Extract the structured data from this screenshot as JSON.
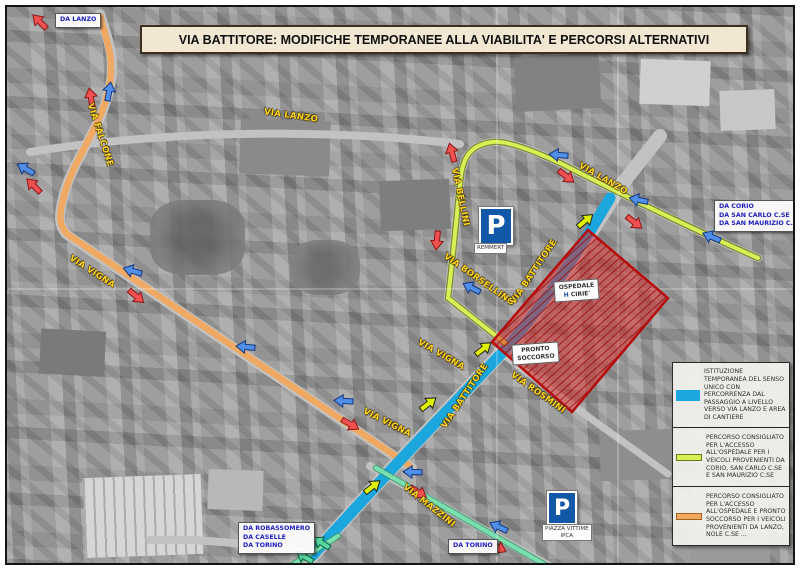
{
  "title": "VIA BATTITORE: MODIFICHE TEMPORANEE ALLA VIABILITA' E PERCORSI ALTERNATIVI",
  "street_labels": {
    "falcone": "VIA FALCONE",
    "vigna_west": "VIA VIGNA",
    "lanzo_top": "VIA LANZO",
    "bellini": "VIA BELLINI",
    "borsellino": "VIA BORSELLINO",
    "battitore_north": "VIA BATTITORE",
    "battitore_south": "VIA BATTITORE",
    "vigna_mid": "VIA VIGNA",
    "vigna_south": "VIA VIGNA",
    "rosmini": "VIA ROSMINI",
    "mazzini": "VIA MAZZINI",
    "lanzo_east": "VIA LANZO"
  },
  "direction_labels": {
    "da_lanzo": {
      "line1": "DA LANZO"
    },
    "da_corio": {
      "line1": "DA CORIO",
      "line2": "DA SAN CARLO C.SE",
      "line3": "DA SAN MAURIZIO C.SE"
    },
    "da_robassomero": {
      "line1": "DA ROBASSOMERO",
      "line2": "DA CASELLE",
      "line3": "DA TORINO"
    },
    "da_torino": {
      "line1": "DA TORINO"
    }
  },
  "closure_area": {
    "ospedale_label": {
      "line1": "OSPEDALE",
      "symbol": "H",
      "line2": "CIRIE'"
    },
    "pronto_soccorso_label": {
      "line1": "PRONTO",
      "line2": "SOCCORSO"
    }
  },
  "parking": {
    "symbol": "P",
    "north_caption": "REMMERT",
    "south_caption_line1": "PIAZZA VITTIME",
    "south_caption_line2": "IPCA"
  },
  "legend": {
    "item1": "ISTITUZIONE TEMPORANEA DEL SENSO UNICO CON PERCORRENZA DAL PASSAGGIO A LIVELLO VERSO VIA LANZO E AREA DI CANTIERE",
    "item2": "PERCORSO CONSIGLIATO PER L'ACCESSO ALL'OSPEDALE PER I VEICOLI PROVENIENTI DA CORIO, SAN CARLO C.SE E SAN MAURIZIO C.SE",
    "item3": "PERCORSO CONSIGLIATO PER L'ACCESSO ALL'OSPEDALE E PRONTO SOCCORSO PER I VEICOLI PROVENIENTI DA LANZO, NOLE C.SE ..."
  },
  "colors": {
    "one_way_route": "#1ba6de",
    "hospital_access_route": "#d9ef55",
    "lanzo_access_route": "#f2a85e",
    "mazzini_route": "#66d6a2",
    "closure_area_red": "#cc2222",
    "street_label_yellow": "#ffd61e",
    "direction_label_blue": "#1c1cc0"
  }
}
